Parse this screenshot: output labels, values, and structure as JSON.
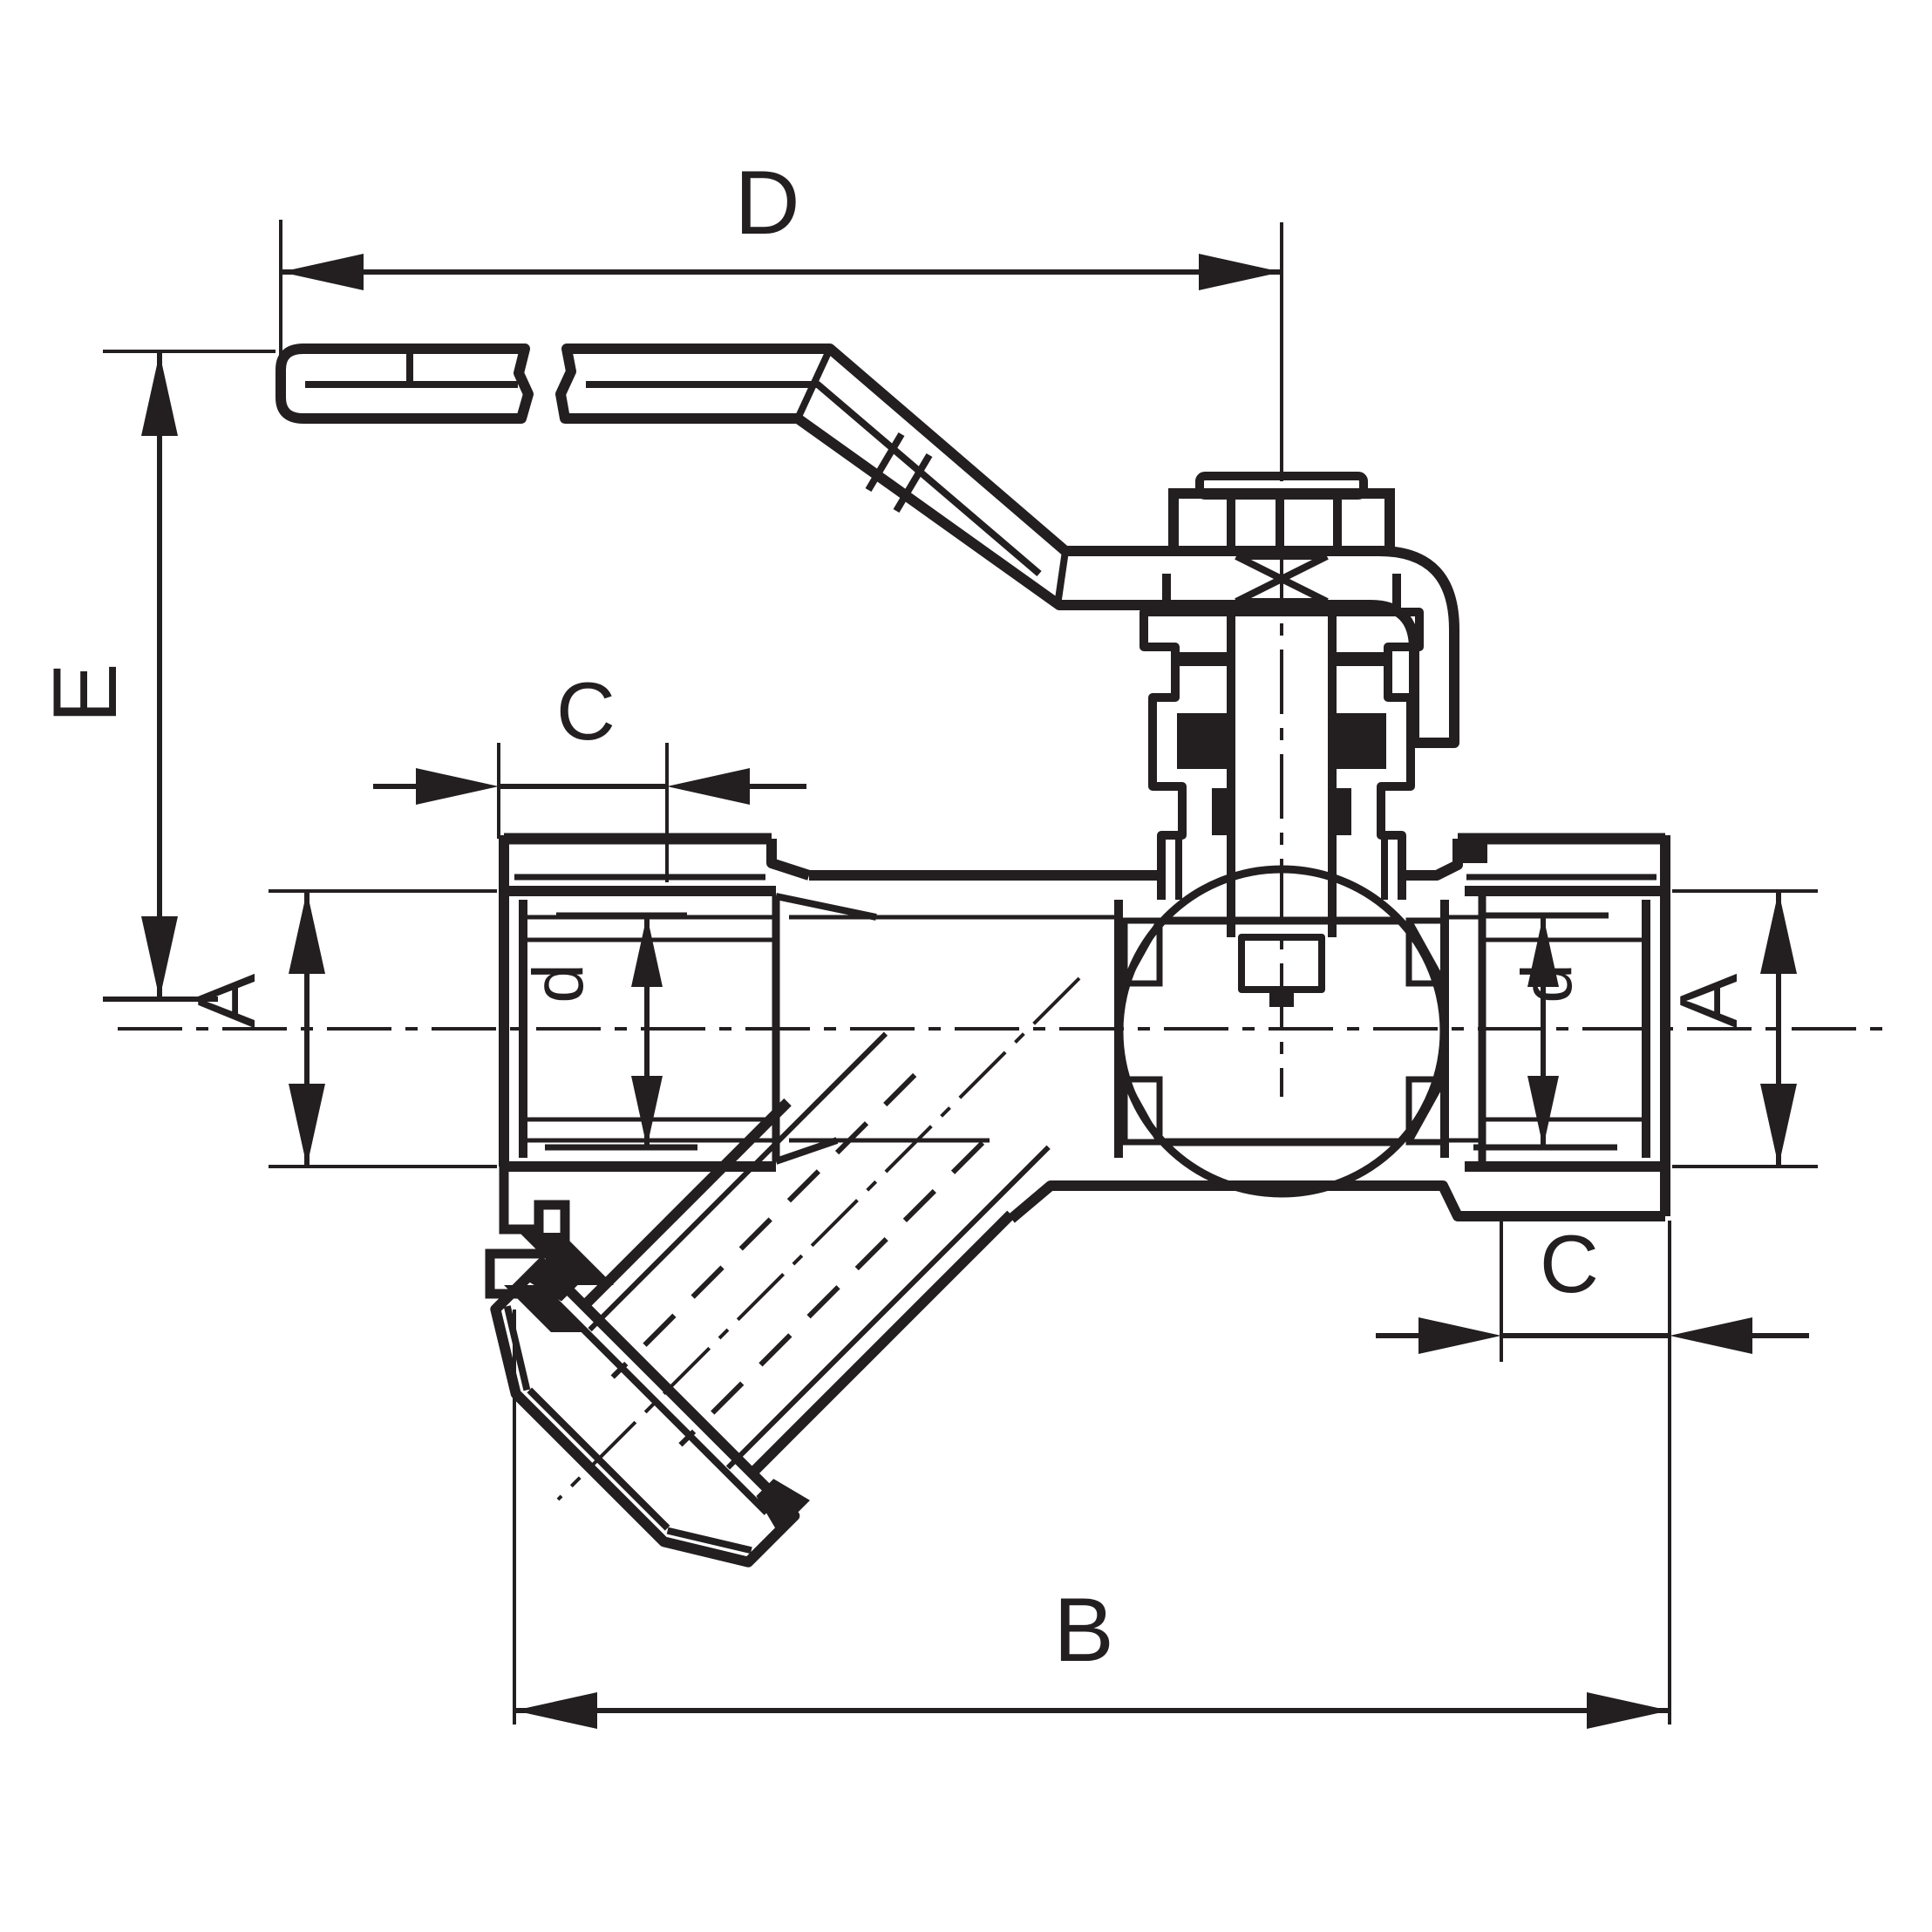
{
  "drawing": {
    "subject": "sectioned ball valve with y-strainer technical dimension drawing",
    "background_color": "#ffffff",
    "line_color": "#231f20",
    "labels": {
      "dim_d_top": "D",
      "dim_e_left": "E",
      "dim_c_left": "C",
      "dim_a_left": "A",
      "dim_bore_left": "d",
      "dim_bore_right": "d",
      "dim_a_right": "A",
      "dim_c_right": "C",
      "dim_b_bottom": "B"
    }
  }
}
